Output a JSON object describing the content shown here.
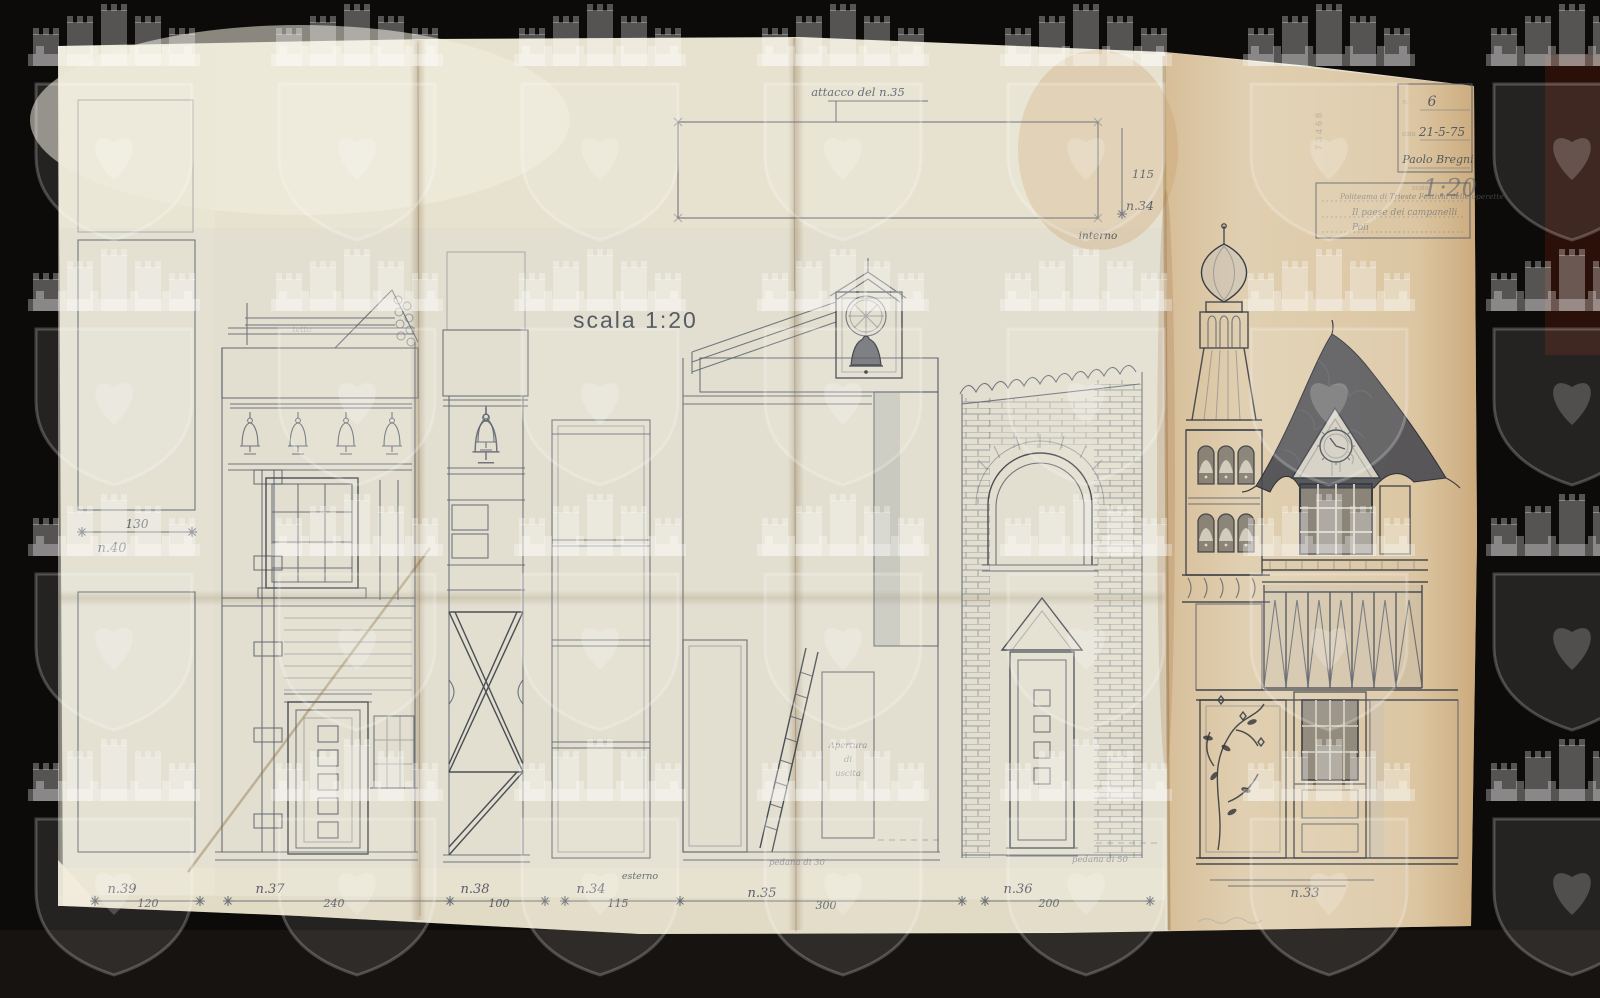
{
  "document": {
    "scale_label": "scala 1:20",
    "stamp_number": "73468",
    "watermark_icon": "castle-shield-heart-watermark",
    "title_block": {
      "sheet_label": "n.",
      "sheet_number": "6",
      "date_label": "data",
      "date_value": "21-5-75",
      "author": "Paolo Bregni",
      "scale_field_label": "scala",
      "scale_field_value": "1:20",
      "production_line1": "Politeama di Trieste  Festival delle operette",
      "production_line2": "Il paese dei campanelli",
      "production_line3": "Poli"
    },
    "annotations": {
      "attacco": "attacco del n.35",
      "interno": "interno",
      "esterno": "esterno",
      "tetto": "tetto",
      "apertura_line1": "Apertura",
      "apertura_line2": "di",
      "apertura_line3": "uscita",
      "pedana_left": "pedana di 30",
      "pedana_right": "pedana di 50",
      "top_piece_height": "115",
      "top_piece_id": "n.34"
    },
    "flats": [
      {
        "id": "n.40",
        "dim": "130"
      },
      {
        "id": "n.39",
        "dim": "120"
      },
      {
        "id": "n.37",
        "dim": "240"
      },
      {
        "id": "n.38",
        "dim": "100"
      },
      {
        "id": "n.34",
        "dim": "115"
      },
      {
        "id": "n.35",
        "dim": "300"
      },
      {
        "id": "n.36",
        "dim": "200"
      },
      {
        "id": "n.33",
        "dim": ""
      }
    ]
  }
}
